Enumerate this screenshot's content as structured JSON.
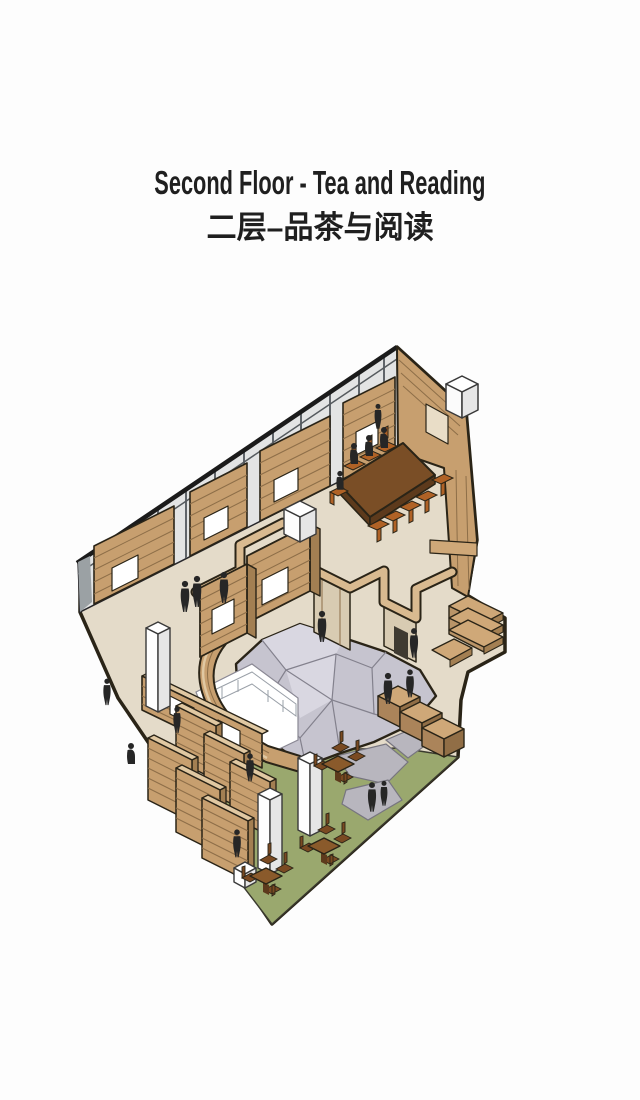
{
  "header": {
    "title_en": "Second Floor - Tea and Reading",
    "title_zh": "二层–品茶与阅读"
  },
  "colors": {
    "bg": "#fdfdfd",
    "ink": "#1f1f1f",
    "outline": "#2a2417",
    "floor": "#e4dbc9",
    "green": "#9aa86e",
    "canopy": "#c6c4cf",
    "canopyLine": "#83818d",
    "canopyHi": "#d9d7e1",
    "stone": "#b8b6be",
    "stoneLine": "#77757f",
    "wood": "#c79f6f",
    "woodTop": "#e0c8a2",
    "woodSide": "#a37f52",
    "woodDark": "#8d6e48",
    "band": "#d9ba90",
    "bandFace": "#d8cbb2",
    "doorDark": "#3f3a31",
    "tableTop": "#7a4e26",
    "tableSide": "#5d3a1c",
    "chair": "#b06226",
    "chairDark": "#7a4a22",
    "teaTable": "#8a5a2b",
    "glass": "#e3e4e4",
    "mullion": "#60656a",
    "railDark": "#1b1b1b",
    "sliver": "#9ba1a4",
    "whiteFace": "#e6e6e6",
    "figure": "#262626",
    "voidStroke": "#8a8894",
    "counterTop": "#cfa878",
    "counterFront": "#ab845a",
    "counterSide": "#916e46"
  },
  "scene": {
    "type": "axonometric-floor-plan",
    "floor": "second floor plate",
    "zones": [
      "reading room with long table",
      "central faceted canopy over atrium void",
      "tea garden with small tables",
      "bookshelf stacks",
      "glazed perimeter wall"
    ]
  }
}
